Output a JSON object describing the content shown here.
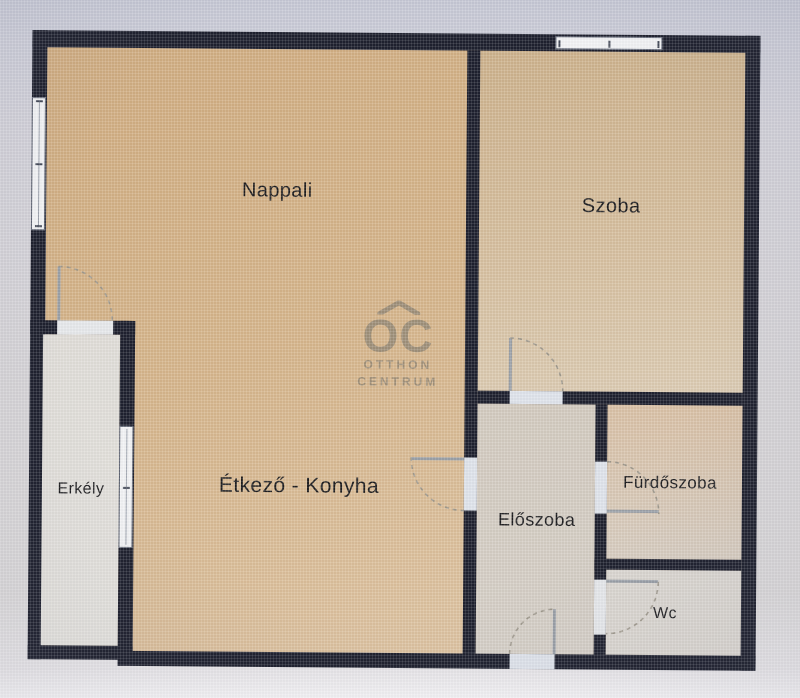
{
  "rooms": [
    {
      "id": "nappali",
      "label": "Nappali"
    },
    {
      "id": "szoba",
      "label": "Szoba"
    },
    {
      "id": "etkezo-konyha",
      "label": "Étkező - Konyha"
    },
    {
      "id": "eloszoba",
      "label": "Előszoba"
    },
    {
      "id": "furdoszoba",
      "label": "Fürdőszoba"
    },
    {
      "id": "wc",
      "label": "Wc"
    },
    {
      "id": "erkely",
      "label": "Erkély"
    }
  ],
  "watermark": {
    "logo": "OC",
    "line1": "OTTHON",
    "line2": "CENTRUM"
  },
  "colors": {
    "wall": "#1e212f",
    "floor_tan": "#d6b68c",
    "floor_light": "#d6d0c8",
    "floor_balcony": "#e3e1dc",
    "window": "#f3f4f6",
    "door_arc": "#a09a8e",
    "watermark": "#7d786e",
    "background": "#d4d3d9"
  }
}
